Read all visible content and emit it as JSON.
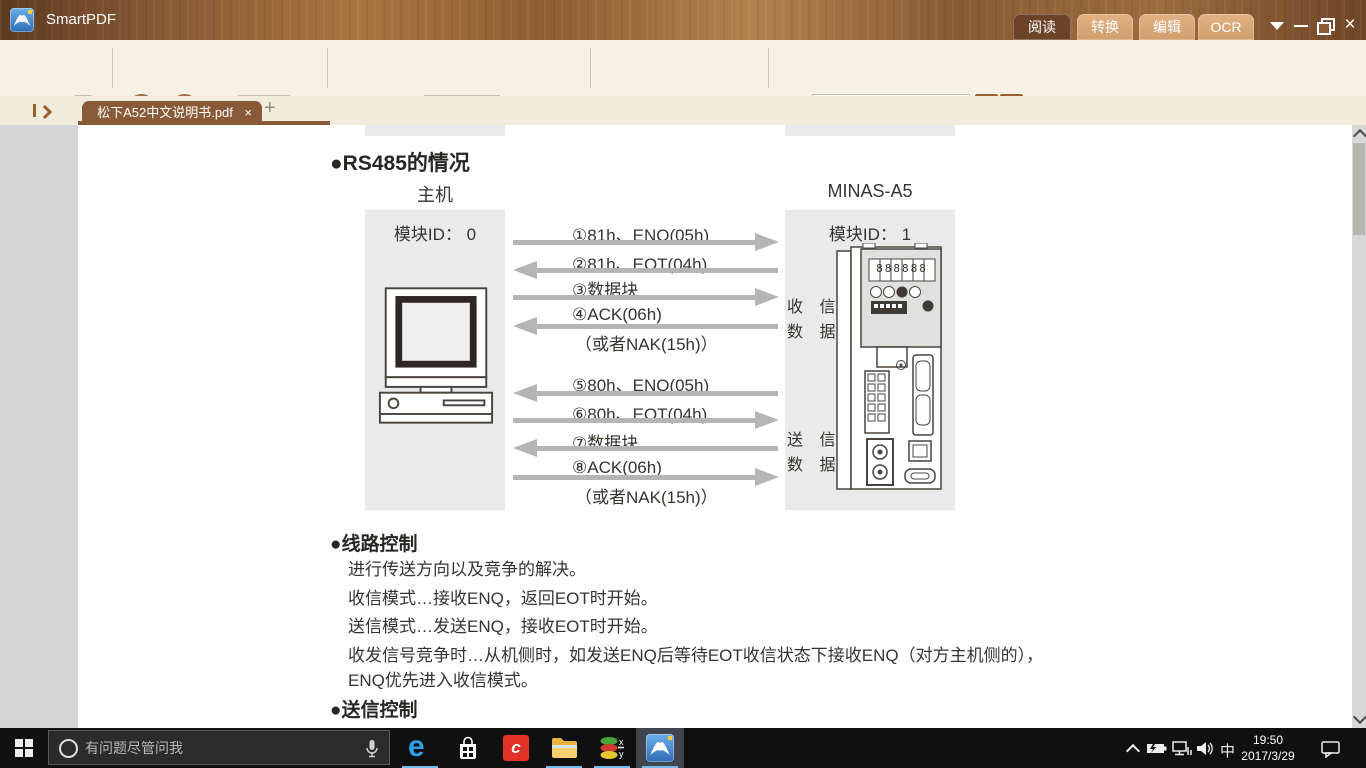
{
  "window": {
    "title": "SmartPDF",
    "mode_tabs": [
      {
        "label": "阅读",
        "active": true
      },
      {
        "label": "转换",
        "active": false
      },
      {
        "label": "编辑",
        "active": false
      },
      {
        "label": "OCR",
        "active": false
      }
    ]
  },
  "toolbar": {
    "page_label": "页码:",
    "page_value": "1-398",
    "page_total": "/512",
    "zoom_value": "150%",
    "find_label": "查找:"
  },
  "tab_bar": {
    "document_tab_title": "松下A52中文说明书.pdf"
  },
  "document": {
    "section_heading": "●RS485的情况",
    "host_title": "主机",
    "device_title": "MINAS-A5",
    "host_module_id": "模块ID： 0",
    "device_module_id": "模块ID： 1",
    "receive_label_row1": "收 信",
    "receive_label_row2": "数 据",
    "send_label_row1": "送 信",
    "send_label_row2": "数 据",
    "display_digits": "888888",
    "sequence1": [
      {
        "label": "①81h、ENQ(05h)",
        "direction": "right"
      },
      {
        "label": "②81h、EOT(04h)",
        "direction": "left"
      },
      {
        "label": "③数据块",
        "direction": "right"
      },
      {
        "label": "④ACK(06h)",
        "direction": "left"
      },
      {
        "label": "（或者NAK(15h)）",
        "direction": "none"
      }
    ],
    "sequence2": [
      {
        "label": "⑤80h、ENQ(05h)",
        "direction": "left"
      },
      {
        "label": "⑥80h、EOT(04h)",
        "direction": "right"
      },
      {
        "label": "⑦数据块",
        "direction": "left"
      },
      {
        "label": "⑧ACK(06h)",
        "direction": "right"
      },
      {
        "label": "（或者NAK(15h)）",
        "direction": "none"
      }
    ],
    "line_control_heading": "●线路控制",
    "line_control_lines": [
      "进行传送方向以及竞争的解决。",
      "收信模式…接收ENQ，返回EOT时开始。",
      "送信模式…发送ENQ，接收EOT时开始。",
      "收发信号竞争时…从机侧时，如发送ENQ后等待EOT收信状态下接收ENQ（对方主机侧的），",
      "ENQ优先进入收信模式。"
    ],
    "send_control_heading": "●送信控制"
  },
  "taskbar": {
    "search_placeholder": "有问题尽管问我",
    "ime_indicator": "中",
    "clock_time": "19:50",
    "clock_date": "2017/3/29"
  },
  "icons": {
    "arrow_left": "←",
    "arrow_right": "→",
    "rotate_left": "↺",
    "rotate_right": "↻",
    "plus": "+",
    "close": "×",
    "edge_letter": "e",
    "red_app_letter": "c",
    "xy_x": "x",
    "xy_y": "y"
  },
  "colors": {
    "accent_brown": "#9a6137",
    "active_mode_tab": "#6d4327",
    "inactive_mode_tab": "#dcab7c",
    "doc_tab": "#8a5a38",
    "toolbar_bg": "#f6f1e5",
    "viewport_bg": "#d4d6d9",
    "diagram_box": "#eaeaea",
    "arrow_gray": "#b5b5b5",
    "taskbar_bg": "#101010",
    "taskbar_underline": "#76b9ed"
  }
}
